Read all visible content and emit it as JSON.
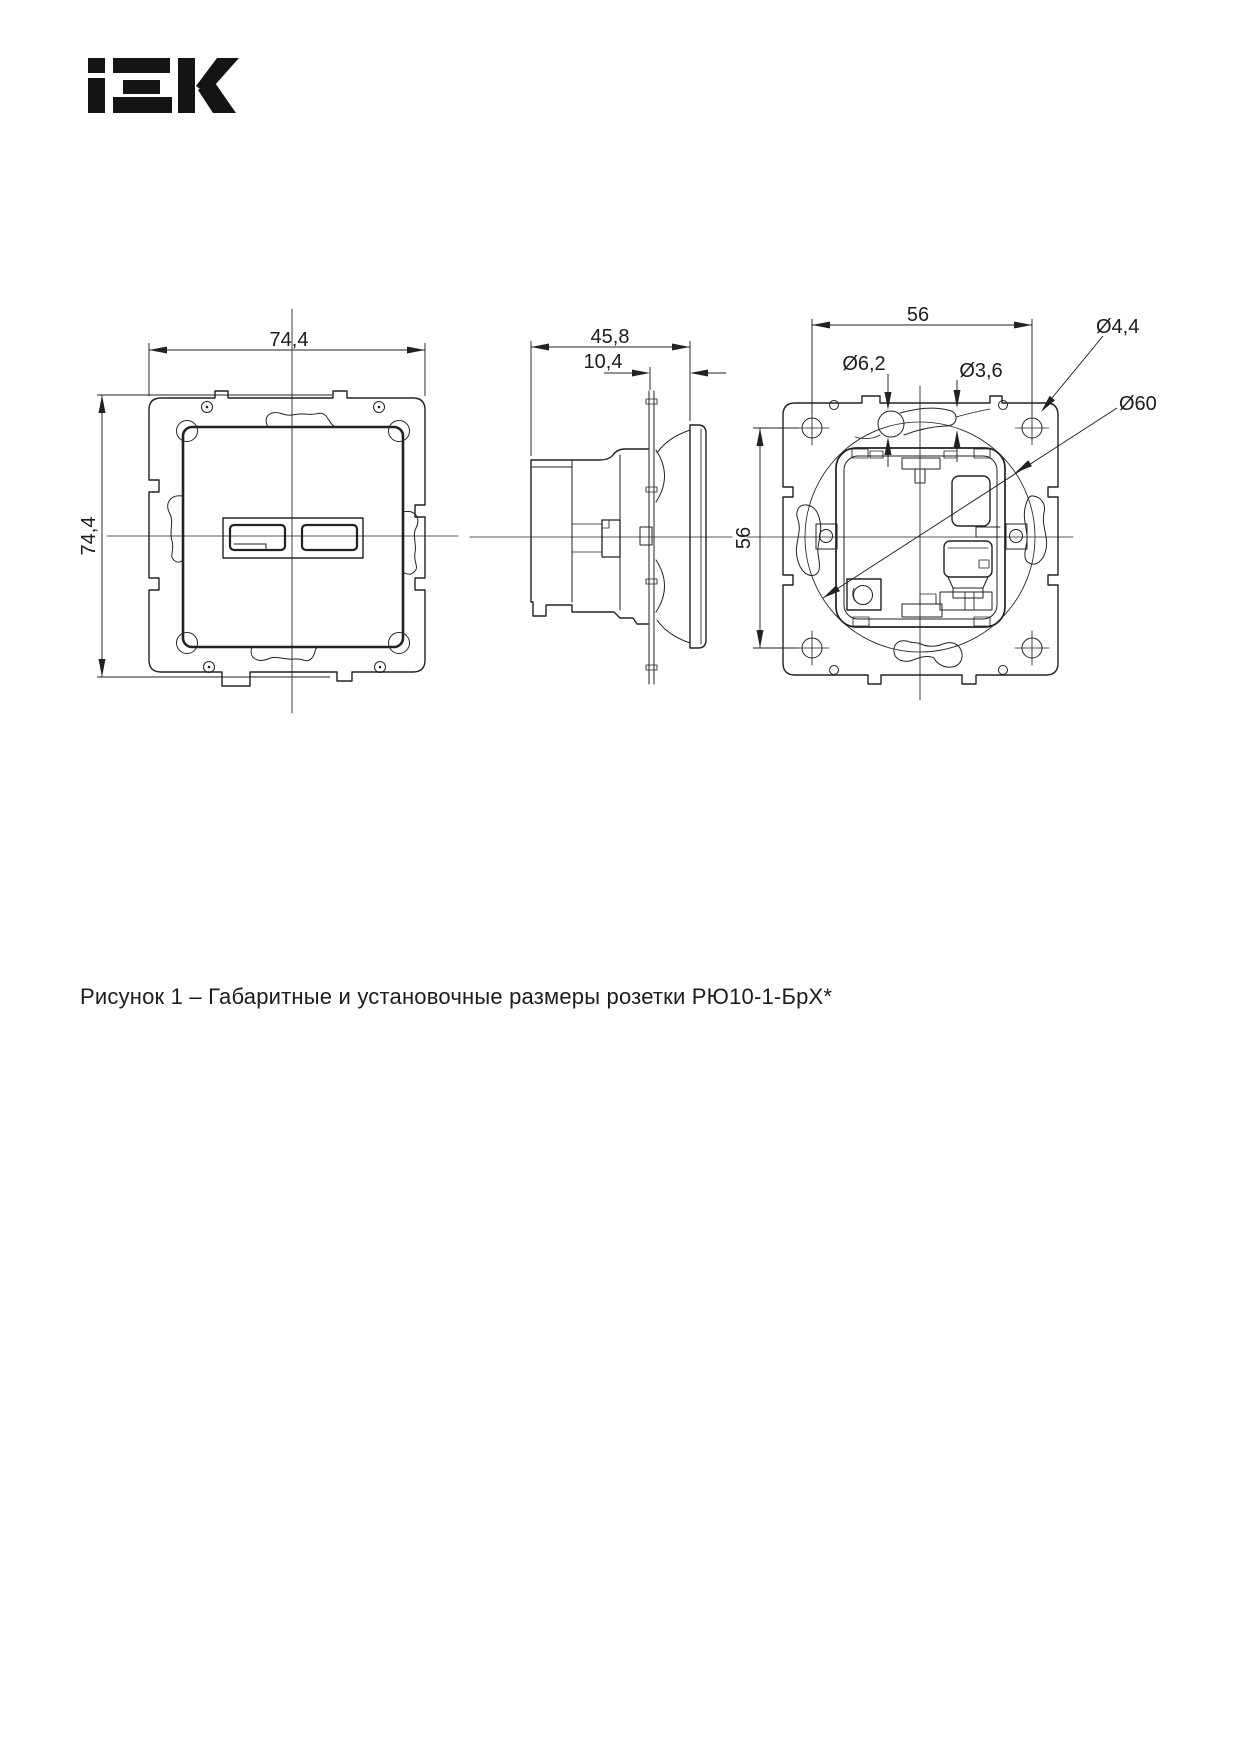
{
  "header": {
    "brand": "IEK"
  },
  "caption": {
    "text": "Рисунок 1 – Габаритные и установочные размеры розетки РЮ10-1-БрХ*"
  },
  "views": {
    "front": {
      "width_mm": "74,4",
      "height_mm": "74,4"
    },
    "side": {
      "depth_mm": "45,8",
      "front_depth_mm": "10,4"
    },
    "back": {
      "hole_spacing_h_mm": "56",
      "hole_spacing_v_mm": "56",
      "keyhole_dia": "Ø6,2",
      "slot_dia": "Ø3,6",
      "screw_hole_dia": "Ø4,4",
      "install_dia": "Ø60"
    }
  },
  "colors": {
    "line": "#222222",
    "background": "#ffffff"
  }
}
